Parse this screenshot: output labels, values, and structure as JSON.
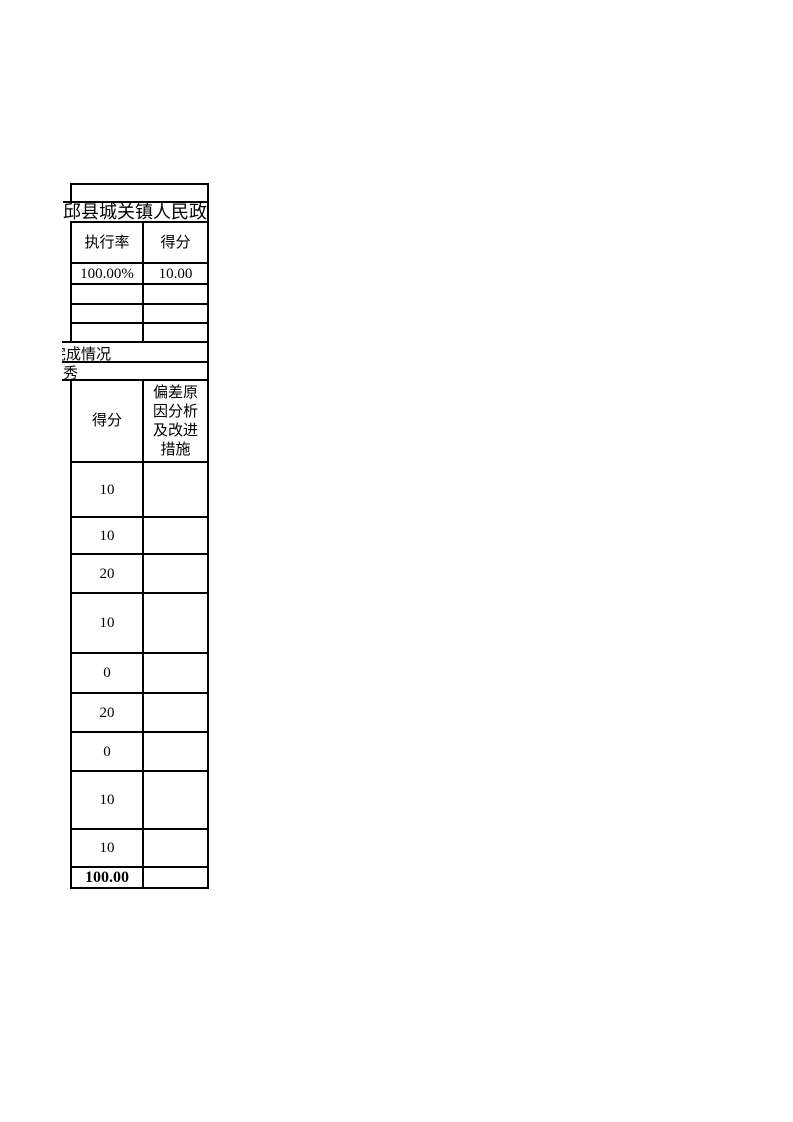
{
  "colors": {
    "background": "#ffffff",
    "text": "#000000",
    "border": "#000000"
  },
  "title_row": {
    "text": "邱县城关镇人民政府"
  },
  "budget_table": {
    "headers": {
      "execution_rate": "执行率",
      "score": "得分"
    },
    "row": {
      "execution_rate": "100.00%",
      "score": "10.00"
    },
    "empty_row_count": 3
  },
  "section_rows": {
    "completion_status": "完成情况",
    "rating": "秀"
  },
  "score_table": {
    "headers": {
      "score": "得分",
      "deviation": "偏差原因分析及改进措施"
    },
    "scores": [
      "10",
      "10",
      "20",
      "10",
      "0",
      "20",
      "0",
      "10",
      "10"
    ],
    "total": "100.00"
  }
}
